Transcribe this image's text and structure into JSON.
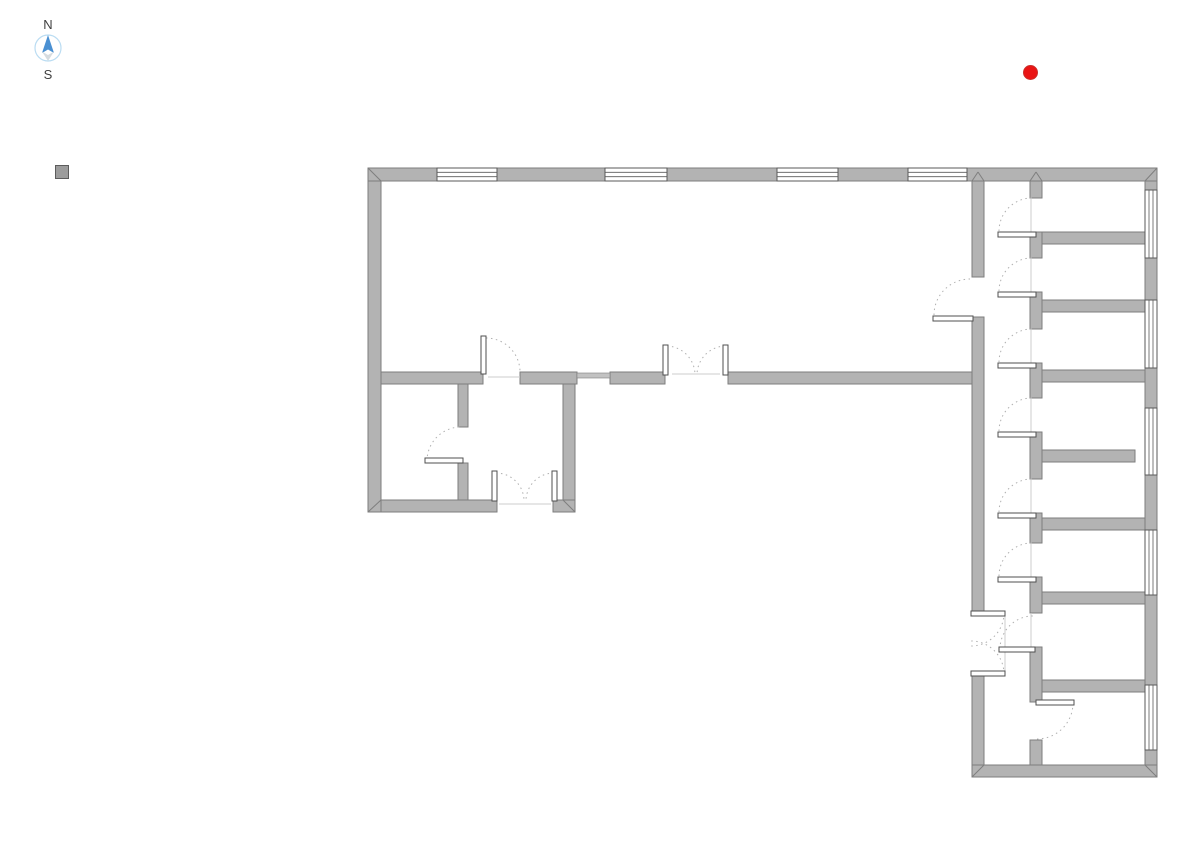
{
  "compass": {
    "north_label": "N",
    "south_label": "S",
    "ring_color": "#badcf2",
    "north_arrow_color": "#4a90d2",
    "south_arrow_color": "#d6dce0"
  },
  "markers": {
    "red_dot": {
      "color": "#ea1414",
      "border": "#c9302c"
    },
    "gray_square": {
      "color": "#9c9c9c",
      "border": "#5c5c5c"
    }
  },
  "plan": {
    "colors": {
      "wall_fill": "#b3b3b3",
      "wall_stroke": "#7e7e7e",
      "thin_wall_fill": "#c2c2c2",
      "window_fill": "#ffffff",
      "window_stroke": "#5a5a5a",
      "door_leaf_fill": "#ffffff",
      "door_leaf_stroke": "#4f4f4f",
      "arc_color": "#b0b0b0",
      "threshold_color": "#cccccc"
    },
    "walls": [
      [
        368,
        168,
        789,
        13
      ],
      [
        368,
        372,
        115,
        12
      ],
      [
        520,
        372,
        57,
        12
      ],
      [
        610,
        372,
        55,
        12
      ],
      [
        728,
        372,
        244,
        12
      ],
      [
        368,
        500,
        129,
        12
      ],
      [
        553,
        500,
        22,
        12
      ],
      [
        972,
        765,
        185,
        12
      ],
      [
        1042,
        232,
        103,
        12
      ],
      [
        1042,
        300,
        103,
        12
      ],
      [
        1042,
        370,
        103,
        12
      ],
      [
        1042,
        450,
        93,
        12
      ],
      [
        1042,
        518,
        103,
        12
      ],
      [
        1042,
        592,
        103,
        12
      ],
      [
        1042,
        680,
        103,
        12
      ],
      [
        368,
        181,
        13,
        331
      ],
      [
        458,
        384,
        10,
        43
      ],
      [
        458,
        463,
        10,
        37
      ],
      [
        563,
        384,
        12,
        116
      ],
      [
        972,
        181,
        12,
        96
      ],
      [
        972,
        317,
        12,
        294
      ],
      [
        972,
        676,
        12,
        89
      ],
      [
        1030,
        181,
        12,
        17
      ],
      [
        1030,
        232,
        12,
        26
      ],
      [
        1030,
        292,
        12,
        37
      ],
      [
        1030,
        363,
        12,
        35
      ],
      [
        1030,
        432,
        12,
        47
      ],
      [
        1030,
        513,
        12,
        30
      ],
      [
        1030,
        577,
        12,
        36
      ],
      [
        1030,
        647,
        12,
        55
      ],
      [
        1030,
        740,
        12,
        25
      ],
      [
        1145,
        181,
        12,
        584
      ]
    ],
    "thin_walls": [
      [
        577,
        373,
        33,
        5
      ]
    ],
    "windows": [
      [
        437,
        168,
        60,
        13
      ],
      [
        605,
        168,
        62,
        13
      ],
      [
        777,
        168,
        61,
        13
      ],
      [
        908,
        168,
        59,
        13
      ],
      [
        1145,
        190,
        12,
        68
      ],
      [
        1145,
        300,
        12,
        68
      ],
      [
        1145,
        408,
        12,
        67
      ],
      [
        1145,
        530,
        12,
        65
      ],
      [
        1145,
        685,
        12,
        65
      ]
    ],
    "door_leaves": [
      [
        998,
        232,
        38,
        5
      ],
      [
        998,
        292,
        38,
        5
      ],
      [
        998,
        363,
        38,
        5
      ],
      [
        998,
        432,
        38,
        5
      ],
      [
        998,
        513,
        38,
        5
      ],
      [
        998,
        577,
        38,
        5
      ],
      [
        999,
        647,
        36,
        5
      ],
      [
        1036,
        700,
        38,
        5
      ],
      [
        933,
        316,
        40,
        5
      ],
      [
        971,
        611,
        34,
        5
      ],
      [
        971,
        671,
        34,
        5
      ],
      [
        481,
        336,
        5,
        38
      ],
      [
        663,
        345,
        5,
        30
      ],
      [
        723,
        345,
        5,
        30
      ],
      [
        492,
        471,
        5,
        30
      ],
      [
        552,
        471,
        5,
        30
      ],
      [
        425,
        458,
        38,
        5
      ]
    ],
    "door_arcs": [
      "M 999 231 A 33 33 0 0 1 1032 198",
      "M 999 291 A 33 33 0 0 1 1032 258",
      "M 999 362 A 33 33 0 0 1 1032 329",
      "M 999 431 A 33 33 0 0 1 1032 398",
      "M 999 512 A 33 33 0 0 1 1032 479",
      "M 999 576 A 33 33 0 0 1 1032 543",
      "M 1000 649 A 33 33 0 0 1 1033 616",
      "M 1073 703 A 36 36 0 0 1 1037 739",
      "M 934 315 A 36 36 0 0 1 970 279",
      "M 1004 613 A 33 33 0 0 1 971 646",
      "M 1004 674 A 33 33 0 0 0 971 641",
      "M 486 338 A 34 34 0 0 1 520 372",
      "M 667 346 A 29 29 0 0 1 695 375",
      "M 725 346 A 29 29 0 0 0 697 375",
      "M 496 473 A 28 28 0 0 1 524 501",
      "M 554 473 A 28 28 0 0 0 526 501",
      "M 427 461 A 34 34 0 0 1 461 427"
    ],
    "threshold_lines": [
      [
        1031,
        198,
        1031,
        232
      ],
      [
        1031,
        258,
        1031,
        292
      ],
      [
        1031,
        329,
        1031,
        363
      ],
      [
        1031,
        398,
        1031,
        432
      ],
      [
        1031,
        479,
        1031,
        513
      ],
      [
        1031,
        543,
        1031,
        577
      ],
      [
        1031,
        613,
        1031,
        647
      ],
      [
        1005,
        616,
        1005,
        671
      ],
      [
        488,
        377,
        520,
        377
      ],
      [
        672,
        374,
        720,
        374
      ],
      [
        499,
        504,
        551,
        504
      ]
    ],
    "miter_lines": [
      [
        368,
        168,
        381,
        181
      ],
      [
        1157,
        168,
        1145,
        181
      ],
      [
        1157,
        777,
        1145,
        765
      ],
      [
        972,
        777,
        984,
        765
      ],
      [
        368,
        512,
        381,
        500
      ],
      [
        563,
        500,
        575,
        512
      ],
      [
        972,
        181,
        978,
        172
      ],
      [
        984,
        181,
        978,
        172
      ],
      [
        1030,
        181,
        1036,
        172
      ],
      [
        1042,
        181,
        1036,
        172
      ]
    ]
  }
}
